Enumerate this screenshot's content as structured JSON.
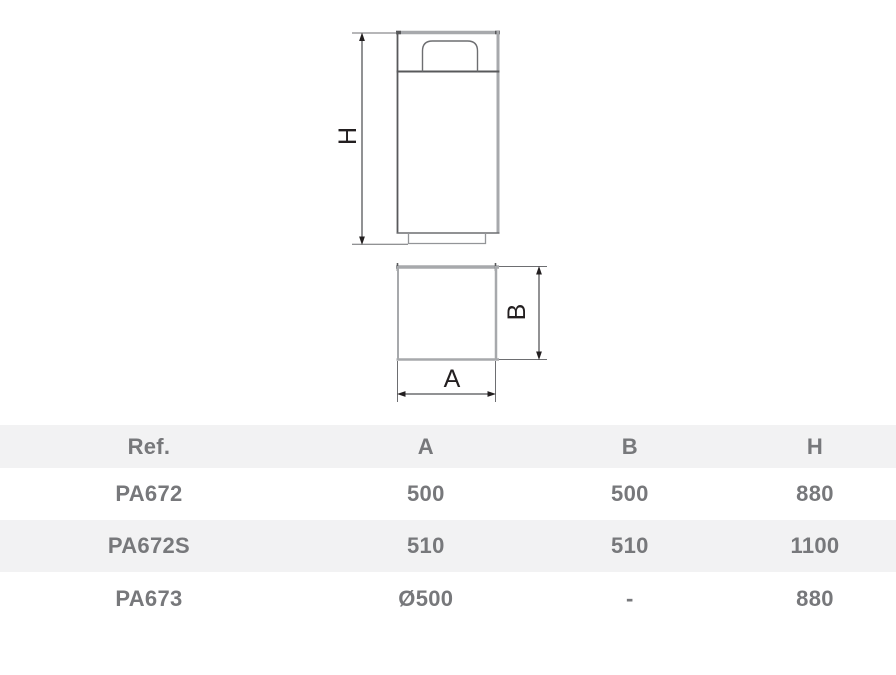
{
  "drawing": {
    "labels": {
      "height": "H",
      "width": "A",
      "depth": "B"
    }
  },
  "table": {
    "headers": [
      "Ref.",
      "A",
      "B",
      "H"
    ],
    "rows": [
      {
        "ref": "PA672",
        "a": "500",
        "b": "500",
        "h": "880"
      },
      {
        "ref": "PA672S",
        "a": "510",
        "b": "510",
        "h": "1100"
      },
      {
        "ref": "PA673",
        "a": "Ø500",
        "b": "-",
        "h": "880"
      }
    ]
  },
  "colors": {
    "table_header_bg": "#f2f2f3",
    "table_row_alt_bg": "#f2f2f3",
    "table_text": "#77787b",
    "outline_gray": "#a7a9ac",
    "outline_dark": "#58595b",
    "outline_mid": "#6d6e71",
    "outline_base": "#939598",
    "dim_line": "#6d6e71",
    "label_color": "#231f20"
  }
}
